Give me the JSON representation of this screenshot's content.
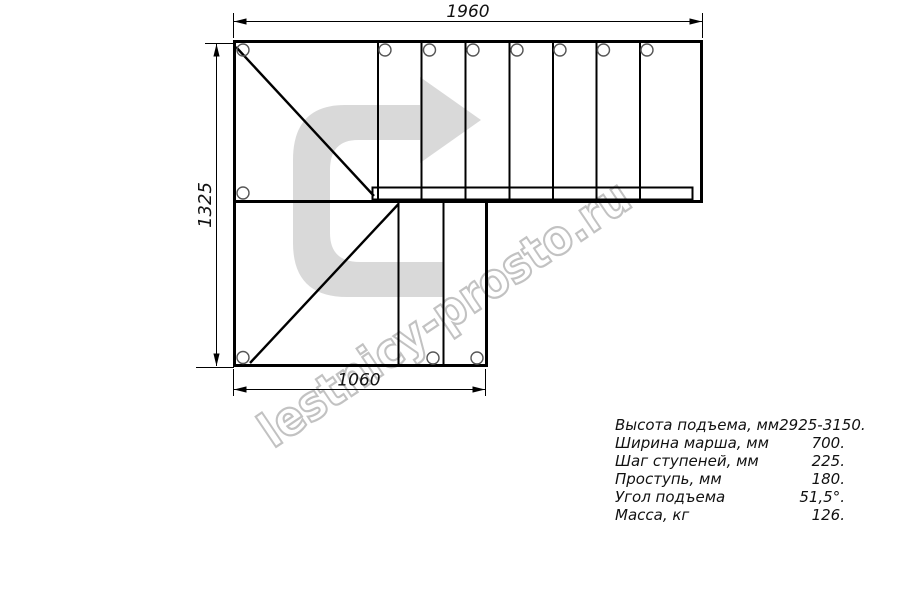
{
  "drawing": {
    "dimensions": {
      "top": "1960",
      "left": "1325",
      "bottom": "1060"
    },
    "watermark": "lestnicy-prosto.ru",
    "colors": {
      "line": "#000000",
      "arrow_fill": "#d9d9d9",
      "watermark_stroke": "#c2c2c2"
    }
  },
  "specs": {
    "rows": [
      {
        "label": "Высота подъема, мм",
        "value": "2925-3150."
      },
      {
        "label": "Ширина марша, мм",
        "value": "700."
      },
      {
        "label": "Шаг ступеней, мм",
        "value": "225."
      },
      {
        "label": "Проступь, мм",
        "value": "180."
      },
      {
        "label": "Угол подъема",
        "value": "51,5°."
      },
      {
        "label": "Масса, кг",
        "value": "126."
      }
    ]
  }
}
